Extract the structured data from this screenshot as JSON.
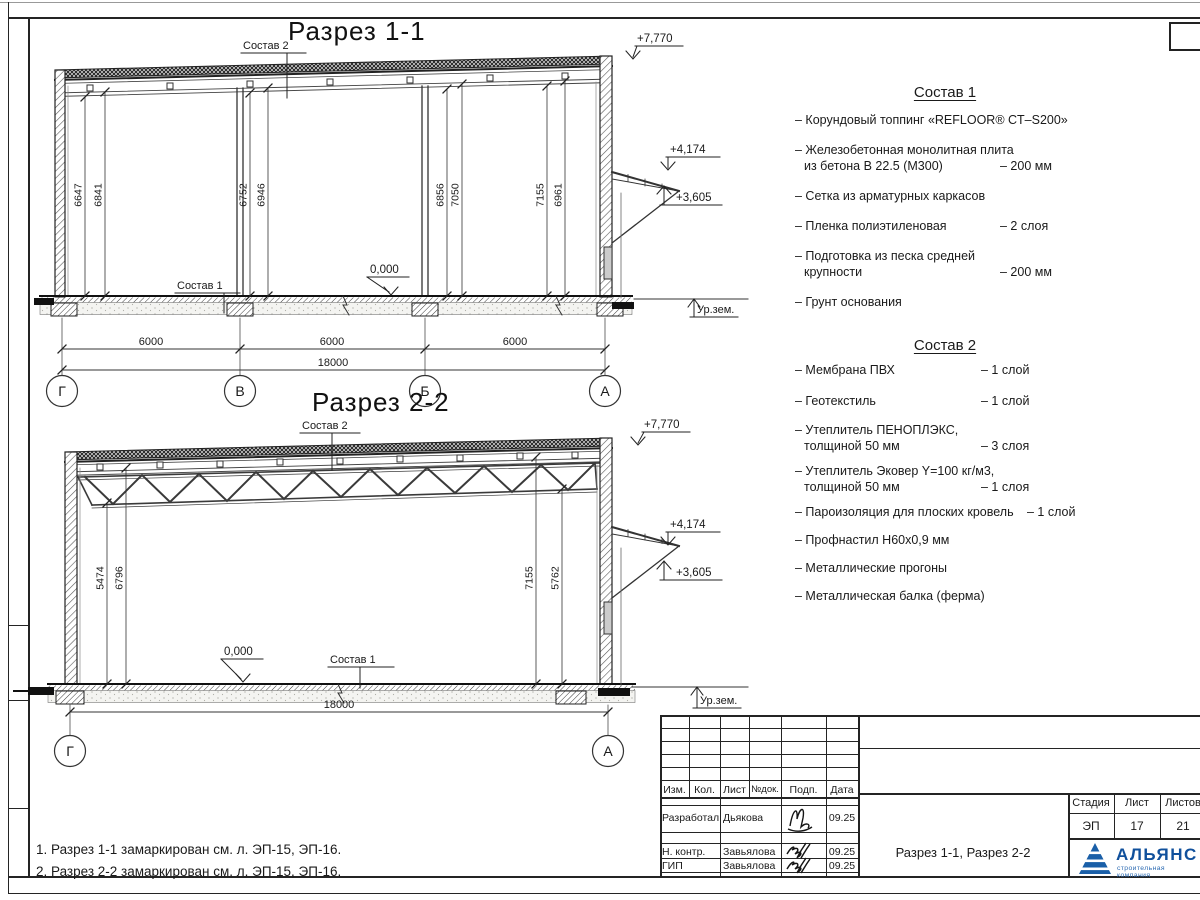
{
  "s1": {
    "title": "Разрез 1-1",
    "labels": {
      "sostav1": "Состав 1",
      "sostav2": "Состав 2"
    },
    "elev": {
      "roof": "+7,770",
      "canopy_top": "+4,174",
      "canopy_bot": "+3,605",
      "floor": "0,000",
      "ground": "Ур.зем."
    },
    "vdims": [
      "6647",
      "6841",
      "6752",
      "6946",
      "6856",
      "7050",
      "7155",
      "6961"
    ],
    "spans": [
      "6000",
      "6000",
      "6000"
    ],
    "total": "18000",
    "axes": [
      "Г",
      "В",
      "Б",
      "А"
    ]
  },
  "s2": {
    "title": "Разрез 2-2",
    "labels": {
      "sostav1": "Состав 1",
      "sostav2": "Состав 2"
    },
    "elev": {
      "roof": "+7,770",
      "canopy_top": "+4,174",
      "canopy_bot": "+3,605",
      "floor": "0,000",
      "ground": "Ур.зем."
    },
    "vdims": [
      "5474",
      "6796",
      "7155",
      "5762"
    ],
    "total": "18000",
    "axes": [
      "Г",
      "А"
    ]
  },
  "c1": {
    "title": "Состав 1",
    "items": [
      {
        "line1": "– Корундовый топпинг «REFLOOR® CT–S200»"
      },
      {
        "line1": "– Железобетонная  монолитная плита",
        "line2": "из бетона В 22.5 (М300)",
        "qty": "– 200 мм"
      },
      {
        "line1": "– Сетка из арматурных каркасов"
      },
      {
        "line1": "– Пленка полиэтиленовая",
        "qty": "– 2 слоя"
      },
      {
        "line1": "– Подготовка из песка средней",
        "line2": "крупности",
        "qty": "– 200 мм"
      },
      {
        "line1": "– Грунт основания"
      }
    ]
  },
  "c2": {
    "title": "Состав 2",
    "items": [
      {
        "line1": "– Мембрана ПВХ",
        "qty": "– 1 слой"
      },
      {
        "line1": "– Геотекстиль",
        "qty": "– 1 слой"
      },
      {
        "line1": "– Утеплитель ПЕНОПЛЭКС,",
        "line2": "толщиной 50 мм",
        "qty": "– 3 слоя"
      },
      {
        "line1": "– Утеплитель Эковер Y=100 кг/м3,",
        "line2": "толщиной 50 мм",
        "qty": "– 1 слоя"
      },
      {
        "line1": "– Пароизоляция для плоских кровель",
        "qty": "– 1 слой"
      },
      {
        "line1": "– Профнастил Н60х0,9 мм"
      },
      {
        "line1": "– Металлические прогоны"
      },
      {
        "line1": "– Металлическая балка (ферма)"
      }
    ]
  },
  "notes": [
    "1. Разрез 1-1 замаркирован см. л. ЭП-15, ЭП-16.",
    "2. Разрез 2-2 замаркирован см. л. ЭП-15, ЭП-16."
  ],
  "tb": {
    "cols": [
      "Изм.",
      "Кол.",
      "Лист",
      "№док.",
      "Подп.",
      "Дата"
    ],
    "rows": [
      {
        "role": "Разработал",
        "name": "Дьякова",
        "date": "09.25"
      },
      {
        "role": "Н. контр.",
        "name": "Завьялова",
        "date": "09.25"
      },
      {
        "role": "ГИП",
        "name": "Завьялова",
        "date": "09.25"
      }
    ],
    "stage_label": "Стадия",
    "sheet_label": "Лист",
    "sheets_label": "Листов",
    "stage": "ЭП",
    "sheet_no": "17",
    "sheets_total": "21",
    "doc_title": "Разрез 1-1, Разрез 2-2",
    "logo": "АЛЬЯНС",
    "logo_sub": "строительная компания",
    "logo_color": "#10509c"
  }
}
